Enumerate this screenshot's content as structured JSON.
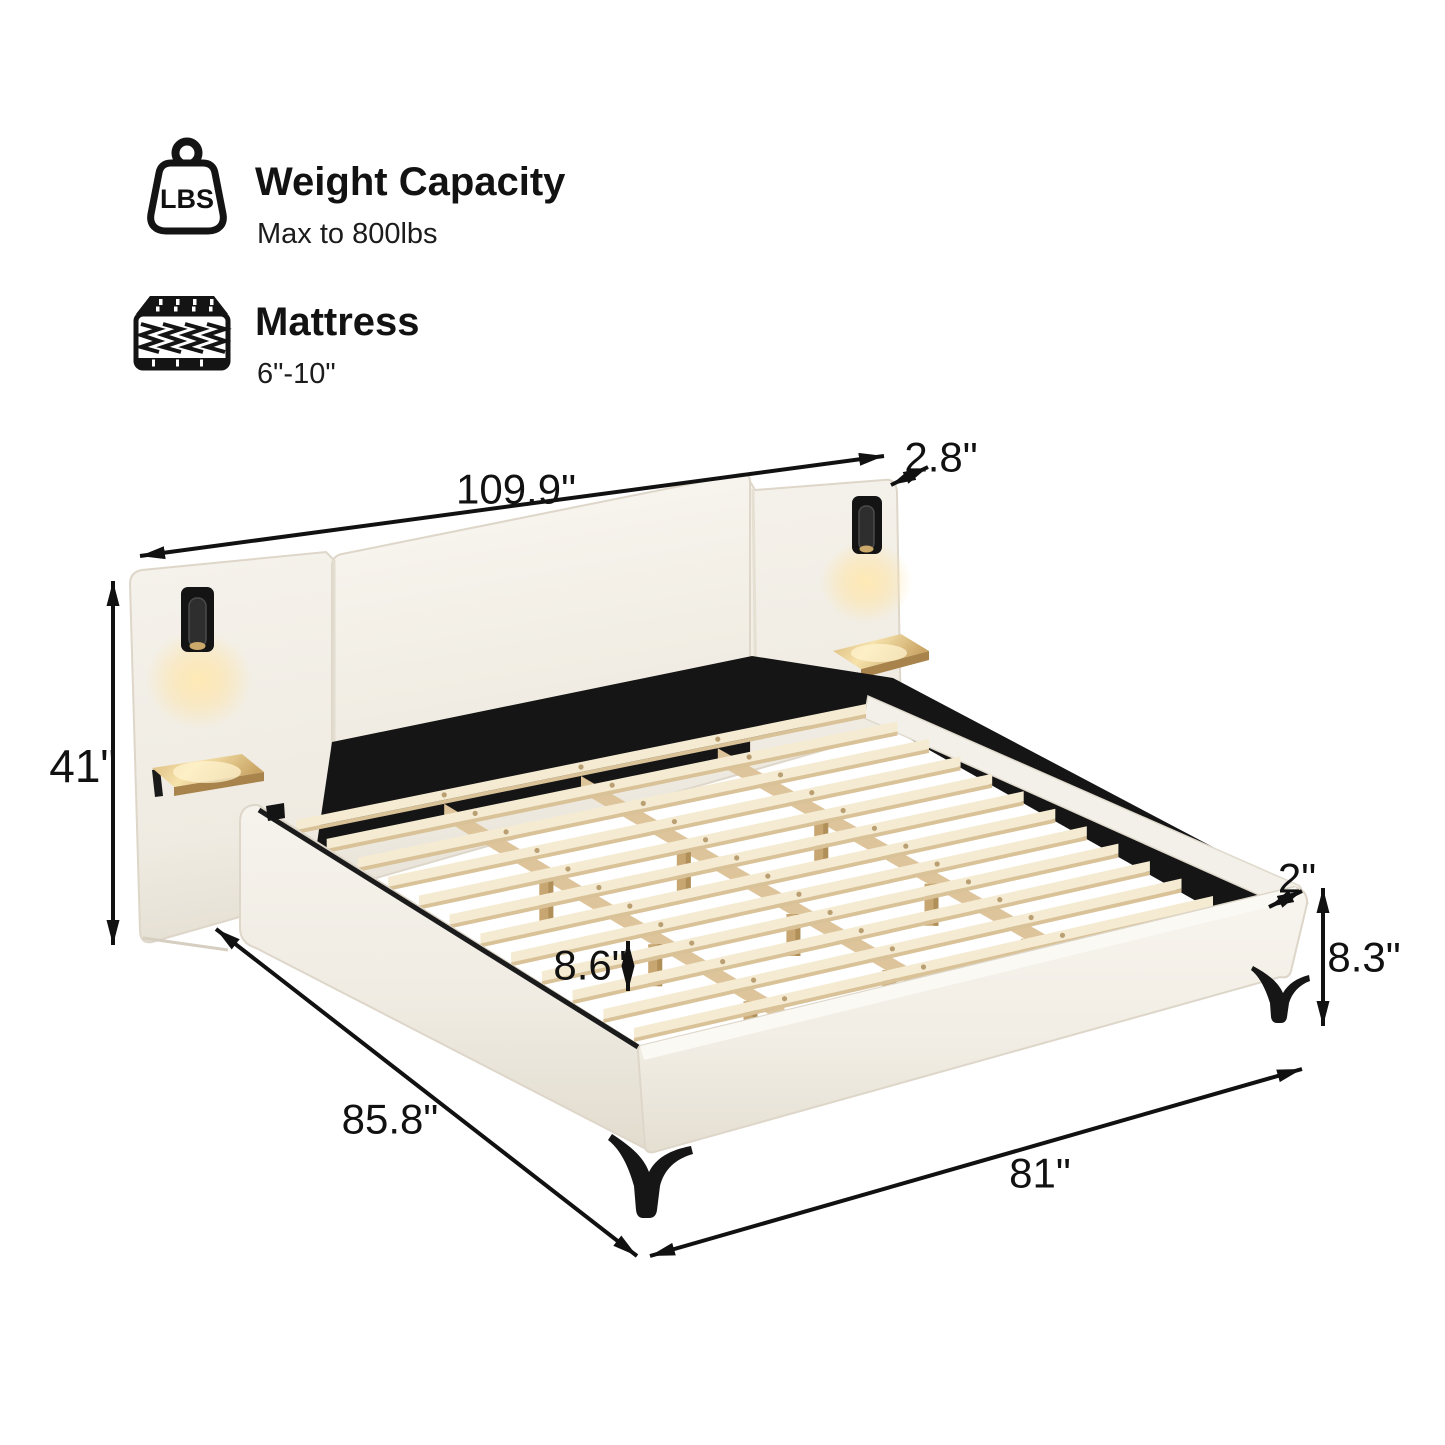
{
  "info": {
    "weight": {
      "icon": "weight-lbs-icon",
      "icon_text": "LBS",
      "title": "Weight Capacity",
      "subtitle": "Max to 800lbs"
    },
    "mattress": {
      "icon": "mattress-icon",
      "title": "Mattress",
      "subtitle": "6\"-10\""
    }
  },
  "dimensions": {
    "headboard_width": "109.9\"",
    "headboard_depth": "2.8\"",
    "headboard_height": "41\"",
    "slat_clearance": "8.6\"",
    "rail_lip": "2\"",
    "frame_side_height": "8.3\"",
    "bed_length": "85.8\"",
    "bed_width": "81\""
  },
  "colors": {
    "fabric": "#f4f1ea",
    "fabric_shadow": "#e6e0d4",
    "accent_black": "#161616",
    "slat_wood": "#f4ebd2",
    "slat_edge": "#d9c297",
    "beam_wood": "#dec49a",
    "shelf_wood": "#c9a464",
    "glow": "#ffe3a0",
    "line": "#111111"
  }
}
